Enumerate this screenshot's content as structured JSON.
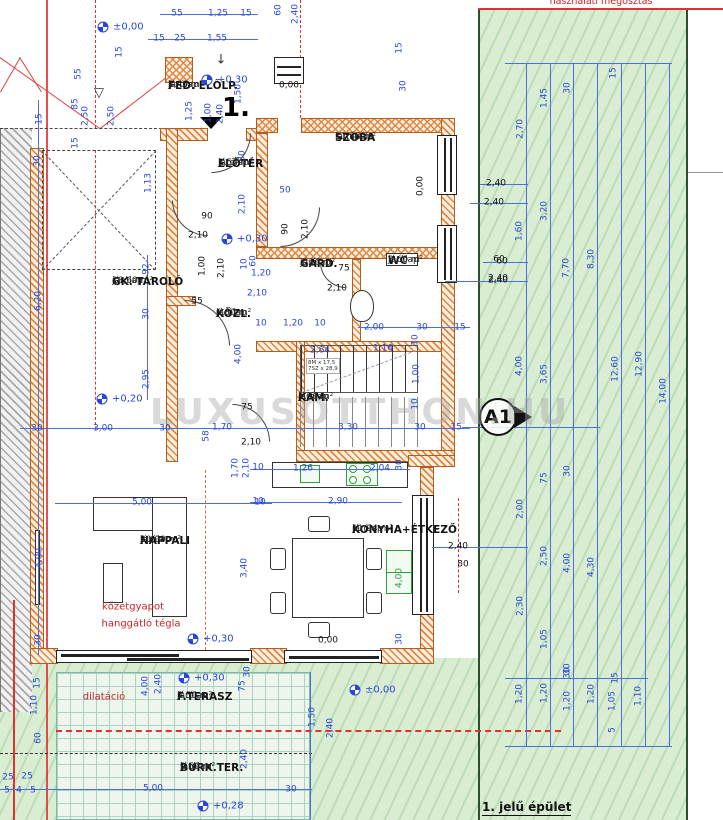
{
  "annotations": {
    "top_note": "használati megosztás",
    "building_label": "1. jelű épület",
    "section_marker": "A1",
    "entrance_number": "1.",
    "watermark": "LUXUSOTTHON.HU",
    "stair_note_line1": "8M x 17,5",
    "stair_note_line2": "7SZ x 28,9",
    "benchmark_symbol": "▽",
    "entry_arrow": "↓"
  },
  "colors": {
    "dimension_blue": "#2946d9",
    "wall_orange": "#cf7030",
    "note_red": "#cc2222",
    "garden_green": "#d8edd2",
    "appliance_green": "#2f9e3f"
  },
  "rooms": [
    {
      "name": "FED. ELŐLP.",
      "finish": "járólap",
      "area": "2,40 m²",
      "x": 168,
      "y": 90
    },
    {
      "name": "ELŐTÉR",
      "finish": "járólap",
      "area": "3,57 m²",
      "x": 218,
      "y": 168
    },
    {
      "name": "SZOBA",
      "finish": "laminált",
      "area": "11,88 m²",
      "x": 335,
      "y": 142
    },
    {
      "name": "GK. TÁROLÓ",
      "finish": "járólap",
      "area": "18,60 m²",
      "x": 112,
      "y": 286
    },
    {
      "name": "GARD.",
      "finish": "járólap",
      "area": "2,16 m²",
      "x": 300,
      "y": 268
    },
    {
      "name": "WC",
      "finish": "járólap",
      "area": "3,60 m²",
      "x": 388,
      "y": 265
    },
    {
      "name": "KÖZL.",
      "finish": "járólap",
      "area": "6,80 m²",
      "x": 216,
      "y": 318
    },
    {
      "name": "KAM.",
      "finish": "járólap",
      "area": "1,26 m²",
      "x": 298,
      "y": 402
    },
    {
      "name": "NAPPALI",
      "finish": "járólap",
      "area": "20,00 m²",
      "x": 140,
      "y": 545
    },
    {
      "name": "KONYHA+ÉTKEZŐ",
      "finish": "járólap",
      "area": "11,94 m²",
      "x": 352,
      "y": 534
    },
    {
      "name": "F.TERASZ",
      "finish": "járólap",
      "area": "5,50 m²",
      "x": 177,
      "y": 701
    },
    {
      "name": "BURK.TER.",
      "finish": "járólap",
      "area": "9,50 m²",
      "x": 180,
      "y": 772
    }
  ],
  "levels": [
    {
      "value": "±0,00",
      "x": 103,
      "y": 27
    },
    {
      "value": "+0,30",
      "x": 207,
      "y": 80
    },
    {
      "value": "+0,30",
      "x": 227,
      "y": 239
    },
    {
      "value": "+0,20",
      "x": 102,
      "y": 399
    },
    {
      "value": "+0,30",
      "x": 193,
      "y": 639
    },
    {
      "value": "+0,30",
      "x": 184,
      "y": 678
    },
    {
      "value": "±0,00",
      "x": 355,
      "y": 690
    },
    {
      "value": "+0,28",
      "x": 203,
      "y": 806
    }
  ],
  "red_notes": [
    {
      "t": "kőzetgyapot",
      "x": 133,
      "y": 607
    },
    {
      "t": "hanggátló tégla",
      "x": 141,
      "y": 624
    },
    {
      "t": "dilatáció",
      "x": 104,
      "y": 697
    }
  ],
  "dimensions": [
    {
      "t": "55",
      "x": 177,
      "y": 14
    },
    {
      "t": "1,25",
      "x": 218,
      "y": 14
    },
    {
      "t": "15",
      "x": 246,
      "y": 14
    },
    {
      "t": "60",
      "x": 279,
      "y": 10,
      "r": 1
    },
    {
      "t": "2,40",
      "x": 296,
      "y": 14,
      "r": 1
    },
    {
      "t": "15",
      "x": 159,
      "y": 39
    },
    {
      "t": "25",
      "x": 180,
      "y": 39
    },
    {
      "t": "1,55",
      "x": 217,
      "y": 39
    },
    {
      "t": "15",
      "x": 120,
      "y": 52,
      "r": 1
    },
    {
      "t": "55",
      "x": 79,
      "y": 74,
      "r": 1
    },
    {
      "t": "85",
      "x": 76,
      "y": 104,
      "r": 1
    },
    {
      "t": "2,50",
      "x": 86,
      "y": 116,
      "r": 1
    },
    {
      "t": "2,50",
      "x": 112,
      "y": 116,
      "r": 1
    },
    {
      "t": "1,25",
      "x": 190,
      "y": 111,
      "r": 1
    },
    {
      "t": "15",
      "x": 40,
      "y": 119,
      "r": 1
    },
    {
      "t": "15",
      "x": 76,
      "y": 143,
      "r": 1
    },
    {
      "t": "30",
      "x": 38,
      "y": 161,
      "r": 1
    },
    {
      "t": "1,13",
      "x": 149,
      "y": 183,
      "r": 1
    },
    {
      "t": "1,00",
      "x": 209,
      "y": 113,
      "r": 1
    },
    {
      "t": "2,40",
      "x": 221,
      "y": 114,
      "r": 1
    },
    {
      "t": "1,50",
      "x": 239,
      "y": 94,
      "r": 1
    },
    {
      "t": "30",
      "x": 243,
      "y": 156,
      "r": 1
    },
    {
      "t": "0,00",
      "x": 289,
      "y": 86,
      "k": "b"
    },
    {
      "t": "15",
      "x": 400,
      "y": 48,
      "r": 1
    },
    {
      "t": "30",
      "x": 404,
      "y": 86,
      "r": 1
    },
    {
      "t": "0,00",
      "x": 421,
      "y": 186,
      "r": 1,
      "k": "b"
    },
    {
      "t": "50",
      "x": 285,
      "y": 191
    },
    {
      "t": "90",
      "x": 207,
      "y": 217,
      "k": "b"
    },
    {
      "t": "2,10",
      "x": 198,
      "y": 236,
      "k": "b"
    },
    {
      "t": "2,10",
      "x": 243,
      "y": 204,
      "r": 1
    },
    {
      "t": "90",
      "x": 286,
      "y": 229,
      "r": 1,
      "k": "b"
    },
    {
      "t": "2,10",
      "x": 306,
      "y": 229,
      "r": 1,
      "k": "b"
    },
    {
      "t": "1,00",
      "x": 203,
      "y": 266,
      "r": 1,
      "k": "b"
    },
    {
      "t": "2,10",
      "x": 222,
      "y": 268,
      "r": 1,
      "k": "b"
    },
    {
      "t": "55",
      "x": 197,
      "y": 302,
      "k": "b"
    },
    {
      "t": "10",
      "x": 245,
      "y": 264,
      "r": 1
    },
    {
      "t": "60",
      "x": 254,
      "y": 261,
      "r": 1
    },
    {
      "t": "1,20",
      "x": 261,
      "y": 274
    },
    {
      "t": "2,10",
      "x": 257,
      "y": 294
    },
    {
      "t": "10",
      "x": 261,
      "y": 324
    },
    {
      "t": "1,20",
      "x": 293,
      "y": 324
    },
    {
      "t": "10",
      "x": 320,
      "y": 324
    },
    {
      "t": "75",
      "x": 344,
      "y": 269,
      "k": "b"
    },
    {
      "t": "2,10",
      "x": 337,
      "y": 289,
      "k": "b"
    },
    {
      "t": "2,00",
      "x": 374,
      "y": 328
    },
    {
      "t": "30",
      "x": 422,
      "y": 328
    },
    {
      "t": "15",
      "x": 460,
      "y": 328
    },
    {
      "t": "1,16",
      "x": 383,
      "y": 349
    },
    {
      "t": "60",
      "x": 499,
      "y": 260,
      "k": "b"
    },
    {
      "t": "2,40",
      "x": 498,
      "y": 279,
      "k": "b"
    },
    {
      "t": "6,20",
      "x": 39,
      "y": 301,
      "r": 1
    },
    {
      "t": "92",
      "x": 147,
      "y": 269,
      "r": 1
    },
    {
      "t": "30",
      "x": 147,
      "y": 314,
      "r": 1
    },
    {
      "t": "2,95",
      "x": 147,
      "y": 379,
      "r": 1
    },
    {
      "t": "30",
      "x": 37,
      "y": 429
    },
    {
      "t": "3,00",
      "x": 103,
      "y": 429
    },
    {
      "t": "30",
      "x": 165,
      "y": 429
    },
    {
      "t": "1,70",
      "x": 222,
      "y": 428
    },
    {
      "t": "58",
      "x": 207,
      "y": 436,
      "r": 1
    },
    {
      "t": "3,30",
      "x": 348,
      "y": 428
    },
    {
      "t": "30",
      "x": 420,
      "y": 428
    },
    {
      "t": "15",
      "x": 456,
      "y": 428
    },
    {
      "t": "4,00",
      "x": 239,
      "y": 354,
      "r": 1
    },
    {
      "t": "75",
      "x": 247,
      "y": 408,
      "k": "b"
    },
    {
      "t": "2,10",
      "x": 251,
      "y": 443,
      "k": "b"
    },
    {
      "t": "2,84",
      "x": 320,
      "y": 351
    },
    {
      "t": "10",
      "x": 416,
      "y": 340,
      "r": 1
    },
    {
      "t": "1,00",
      "x": 417,
      "y": 374,
      "r": 1
    },
    {
      "t": "10",
      "x": 416,
      "y": 404,
      "r": 1
    },
    {
      "t": "1,70",
      "x": 236,
      "y": 468,
      "r": 1
    },
    {
      "t": "2,10",
      "x": 247,
      "y": 468,
      "r": 1
    },
    {
      "t": "10",
      "x": 258,
      "y": 468
    },
    {
      "t": "1,26",
      "x": 303,
      "y": 469
    },
    {
      "t": "2,04",
      "x": 380,
      "y": 469
    },
    {
      "t": "30",
      "x": 400,
      "y": 465,
      "r": 1
    },
    {
      "t": "10",
      "x": 258,
      "y": 502
    },
    {
      "t": "2,90",
      "x": 338,
      "y": 502
    },
    {
      "t": "4,00",
      "x": 400,
      "y": 578,
      "r": 1,
      "k": "g"
    },
    {
      "t": "30",
      "x": 400,
      "y": 639,
      "r": 1
    },
    {
      "t": "0,00",
      "x": 328,
      "y": 641,
      "k": "b"
    },
    {
      "t": "2,40",
      "x": 458,
      "y": 547,
      "k": "b"
    },
    {
      "t": "80",
      "x": 463,
      "y": 565,
      "k": "b"
    },
    {
      "t": "5,00",
      "x": 142,
      "y": 503
    },
    {
      "t": "10",
      "x": 260,
      "y": 503
    },
    {
      "t": "4,00",
      "x": 40,
      "y": 558,
      "r": 1
    },
    {
      "t": "3,40",
      "x": 245,
      "y": 568,
      "r": 1
    },
    {
      "t": "30",
      "x": 39,
      "y": 640,
      "r": 1
    },
    {
      "t": "15",
      "x": 38,
      "y": 683,
      "r": 1
    },
    {
      "t": "1,10",
      "x": 35,
      "y": 705,
      "r": 1
    },
    {
      "t": "60",
      "x": 39,
      "y": 738,
      "r": 1
    },
    {
      "t": "4,00",
      "x": 146,
      "y": 686,
      "r": 1
    },
    {
      "t": "2,40",
      "x": 159,
      "y": 684,
      "r": 1
    },
    {
      "t": "75",
      "x": 243,
      "y": 686,
      "r": 1
    },
    {
      "t": "30",
      "x": 248,
      "y": 672,
      "r": 1
    },
    {
      "t": "2,40",
      "x": 245,
      "y": 759,
      "r": 1
    },
    {
      "t": "1,50",
      "x": 313,
      "y": 717,
      "r": 1
    },
    {
      "t": "2,40",
      "x": 331,
      "y": 728,
      "r": 1
    },
    {
      "t": "5,00",
      "x": 153,
      "y": 789
    },
    {
      "t": "30",
      "x": 291,
      "y": 790
    },
    {
      "t": "25",
      "x": 8,
      "y": 778
    },
    {
      "t": "25",
      "x": 27,
      "y": 777
    },
    {
      "t": "5",
      "x": 7,
      "y": 791
    },
    {
      "t": "4",
      "x": 19,
      "y": 791
    },
    {
      "t": "5",
      "x": 33,
      "y": 791
    },
    {
      "t": "2,70",
      "x": 521,
      "y": 129,
      "r": 1
    },
    {
      "t": "1,45",
      "x": 545,
      "y": 98,
      "r": 1
    },
    {
      "t": "30",
      "x": 568,
      "y": 88,
      "r": 1
    },
    {
      "t": "15",
      "x": 614,
      "y": 73,
      "r": 1
    },
    {
      "t": "2,40",
      "x": 496,
      "y": 184,
      "k": "b"
    },
    {
      "t": "2,40",
      "x": 494,
      "y": 203,
      "k": "b"
    },
    {
      "t": "3,20",
      "x": 545,
      "y": 211,
      "r": 1
    },
    {
      "t": "1,60",
      "x": 520,
      "y": 231,
      "r": 1
    },
    {
      "t": "60",
      "x": 502,
      "y": 262,
      "k": "b"
    },
    {
      "t": "2,40",
      "x": 498,
      "y": 281,
      "k": "b"
    },
    {
      "t": "7,70",
      "x": 567,
      "y": 268,
      "r": 1
    },
    {
      "t": "8,30",
      "x": 592,
      "y": 259,
      "r": 1
    },
    {
      "t": "4,00",
      "x": 520,
      "y": 366,
      "r": 1
    },
    {
      "t": "3,65",
      "x": 545,
      "y": 374,
      "r": 1
    },
    {
      "t": "12,60",
      "x": 616,
      "y": 369,
      "r": 1
    },
    {
      "t": "12,90",
      "x": 640,
      "y": 364,
      "r": 1
    },
    {
      "t": "14,00",
      "x": 664,
      "y": 391,
      "r": 1
    },
    {
      "t": "75",
      "x": 545,
      "y": 478,
      "r": 1
    },
    {
      "t": "30",
      "x": 568,
      "y": 471,
      "r": 1
    },
    {
      "t": "2,00",
      "x": 521,
      "y": 509,
      "r": 1
    },
    {
      "t": "2,50",
      "x": 545,
      "y": 556,
      "r": 1
    },
    {
      "t": "4,00",
      "x": 568,
      "y": 563,
      "r": 1
    },
    {
      "t": "4,30",
      "x": 592,
      "y": 567,
      "r": 1
    },
    {
      "t": "2,30",
      "x": 521,
      "y": 606,
      "r": 1
    },
    {
      "t": "1,05",
      "x": 545,
      "y": 639,
      "r": 1
    },
    {
      "t": "30",
      "x": 568,
      "y": 669,
      "r": 1
    },
    {
      "t": "1,20",
      "x": 520,
      "y": 694,
      "r": 1
    },
    {
      "t": "1,20",
      "x": 545,
      "y": 693,
      "r": 1
    },
    {
      "t": "30",
      "x": 568,
      "y": 673,
      "r": 1
    },
    {
      "t": "1,20",
      "x": 568,
      "y": 701,
      "r": 1
    },
    {
      "t": "1,20",
      "x": 592,
      "y": 694,
      "r": 1
    },
    {
      "t": "15",
      "x": 616,
      "y": 678,
      "r": 1
    },
    {
      "t": "1,05",
      "x": 613,
      "y": 701,
      "r": 1
    },
    {
      "t": "1,10",
      "x": 639,
      "y": 696,
      "r": 1
    },
    {
      "t": "5",
      "x": 613,
      "y": 730,
      "r": 1
    }
  ]
}
